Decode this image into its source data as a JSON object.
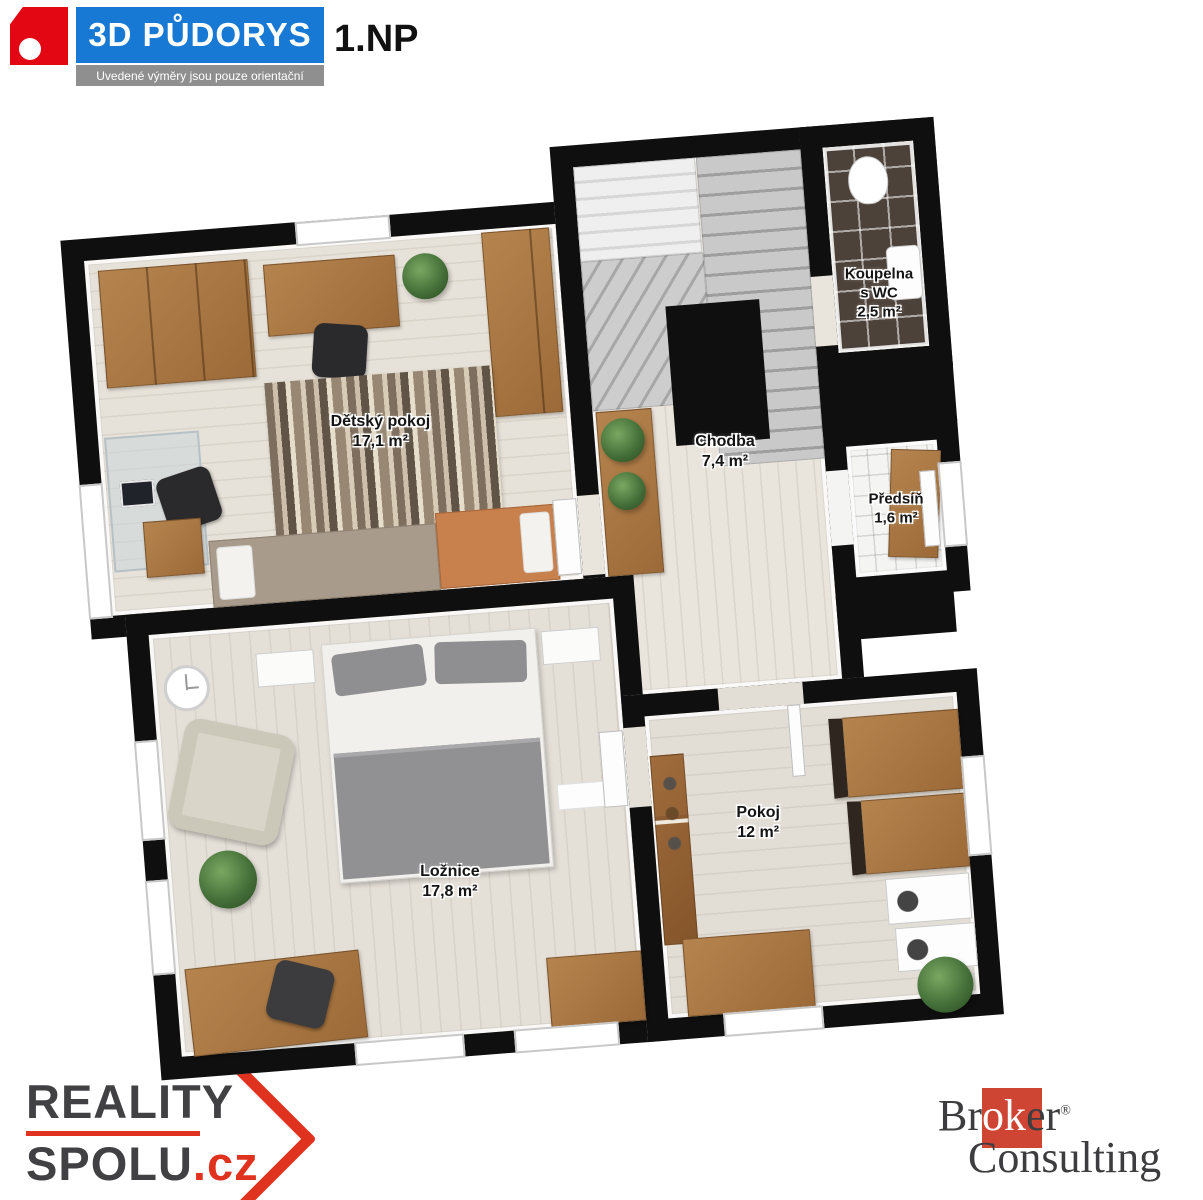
{
  "header": {
    "brand": "3D PŮDORYS",
    "floor": "1.NP",
    "disclaimer": "Uvedené výměry jsou pouze orientační"
  },
  "rooms": {
    "detsky": {
      "name": "Dětský pokoj",
      "area": "17,1 m²"
    },
    "chodba": {
      "name": "Chodba",
      "area": "7,4 m²"
    },
    "koupelna": {
      "name": "Koupelna",
      "name2": "s WC",
      "area": "2,5 m²"
    },
    "predsin": {
      "name": "Předsíň",
      "area": "1,6 m²"
    },
    "loznice": {
      "name": "Ložnice",
      "area": "17,8 m²"
    },
    "pokoj": {
      "name": "Pokoj",
      "area": "12 m²"
    }
  },
  "footer": {
    "left": {
      "line1": "REALITY",
      "line2": "SPOLU",
      "suffix": ".cz"
    },
    "right": {
      "part1": "Br",
      "part2": "ok",
      "part3": "er",
      "reg": "®",
      "line2": "Consulting"
    }
  },
  "colors": {
    "banner_blue": "#1779d3",
    "logo_red": "#e30613",
    "wall_black": "#0f0f0f",
    "reality_red": "#e0331f",
    "broker_red": "#cf4534"
  }
}
